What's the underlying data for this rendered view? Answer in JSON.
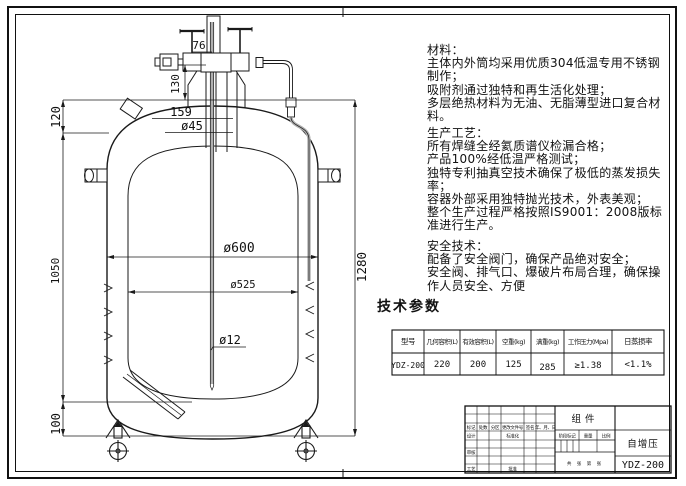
{
  "sheet": {
    "background": "#ffffff",
    "line_color": "#1a1a1a",
    "pipe_gray": "#b0b0b0"
  },
  "notes": {
    "materials": "材料：\n主体内外筒均采用优质304低温专用不锈钢\n制作；\n吸附剂通过独特和再生活化处理；\n多层绝热材料为无油、无脂薄型进口复合材\n料。",
    "process": "生产工艺：\n所有焊缝全经氦质谱仪检漏合格；\n产品100%经低温严格测试；\n独特专利抽真空技术确保了极低的蒸发损失\n率；\n容器外部采用独特抛光技术，外表美观；\n整个生产过程严格按照IS9001：2008版标\n准进行生产。",
    "safety": "安全技术：\n配备了安全阀门，确保产品绝对安全；\n安全阀、排气口、爆破片布局合理，确保操\n作人员安全、方便"
  },
  "params": {
    "heading": "技术参数",
    "columns": [
      "型号",
      "几何容积(L)",
      "有效容积(L)",
      "空重(kg)",
      "满重(kg)",
      "工作压力(Mpa)",
      "日蒸损率"
    ],
    "values": [
      "YDZ-200",
      "220",
      "200",
      "125",
      "285",
      "≥1.38",
      "<1.1%"
    ]
  },
  "titleblock": {
    "part_name": "组件",
    "subtitle": "自增压",
    "model": "YDZ-200",
    "rev_headers": [
      "标记",
      "处数",
      "分区",
      "更改文件号",
      "签名",
      "年、月、日"
    ],
    "design_label": "设计",
    "standard_label": "标准化",
    "check_label": "审核",
    "process_label": "工艺",
    "approve_label": "批准",
    "stage_label": "阶段标记",
    "weight_label": "重量",
    "scale_label": "比例",
    "sheets_label": "共 张 第 张"
  },
  "drawing": {
    "dims": {
      "top_width": "76",
      "neck_height": "130",
      "dome_height": "120",
      "flange_width": "159",
      "neck_dia": "ø45",
      "body_height": "1050",
      "caster_height": "100",
      "total_height": "1280",
      "outer_dia": "ø600",
      "inner_dia": "ø525",
      "tube_dia": "ø12"
    }
  }
}
